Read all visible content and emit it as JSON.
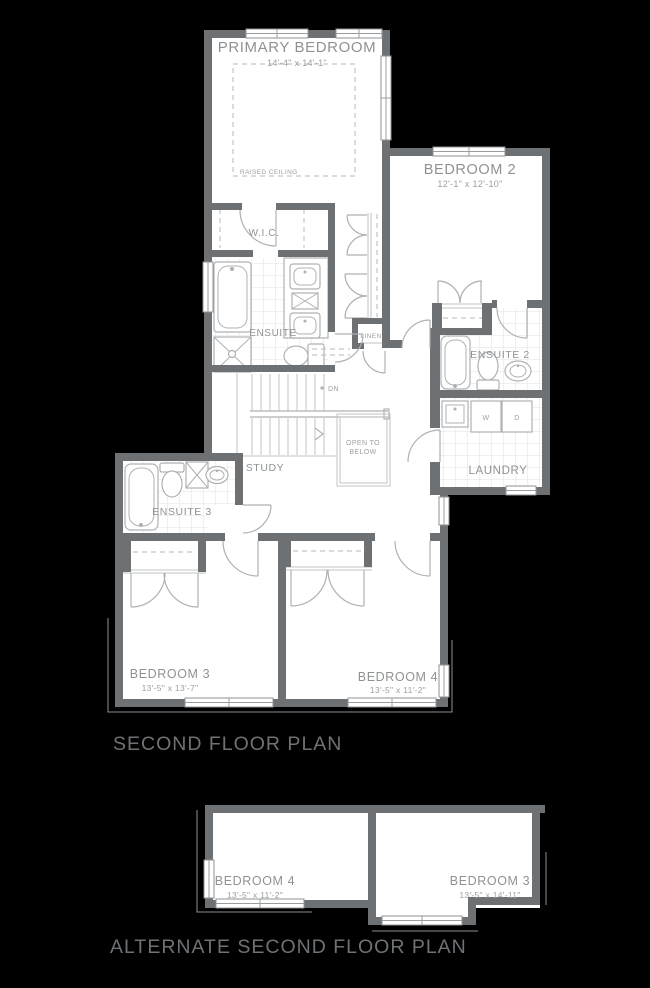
{
  "colors": {
    "background": "#000000",
    "walls": "#6e7173",
    "floor": "#ffffff",
    "fixture_lines": "#aeb1b3",
    "room_labels": "#8f9295",
    "titles": "#6f7275"
  },
  "main_plan": {
    "title": "SECOND FLOOR PLAN",
    "primary_bedroom": {
      "name": "PRIMARY BEDROOM",
      "dims": "14'-4\" x 14'-1\"",
      "ceiling_note": "RAISED CEILING"
    },
    "bedroom2": {
      "name": "BEDROOM 2",
      "dims": "12'-1\" x 12'-10\""
    },
    "wic": {
      "name": "W.I.C."
    },
    "ensuite": {
      "name": "ENSUITE"
    },
    "linen": {
      "name": "LINEN"
    },
    "ensuite2": {
      "name": "ENSUITE 2"
    },
    "laundry": {
      "name": "LAUNDRY",
      "washer": "W",
      "dryer": "D"
    },
    "stairs": {
      "down": "DN"
    },
    "open_to_below": {
      "line1": "OPEN TO",
      "line2": "BELOW"
    },
    "study": {
      "name": "STUDY"
    },
    "ensuite3": {
      "name": "ENSUITE 3"
    },
    "bedroom3": {
      "name": "BEDROOM 3",
      "dims": "13'-5\" x 13'-7\""
    },
    "bedroom4": {
      "name": "BEDROOM 4",
      "dims": "13'-5\" x 11'-2\""
    }
  },
  "alternate_plan": {
    "title": "ALTERNATE SECOND FLOOR PLAN",
    "bedroom4": {
      "name": "BEDROOM 4",
      "dims": "13'-5\" x 11'-2\""
    },
    "bedroom3": {
      "name": "BEDROOM 3",
      "dims": "13'-5\" x 14'-11\""
    }
  }
}
